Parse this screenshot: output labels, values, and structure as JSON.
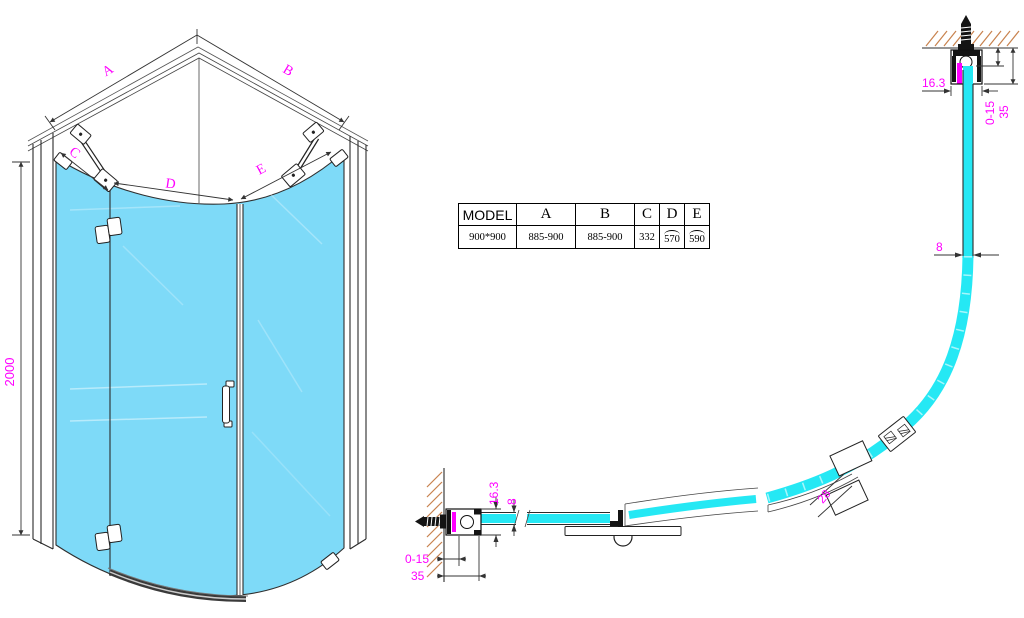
{
  "table": {
    "headers": [
      "MODEL",
      "A",
      "B",
      "C",
      "D",
      "E"
    ],
    "row": {
      "model": "900*900",
      "a": "885-900",
      "b": "885-900",
      "c": "332",
      "d": "570",
      "e": "590"
    }
  },
  "front_view": {
    "height": "2000",
    "dim_a": "A",
    "dim_b": "B",
    "dim_c": "C",
    "dim_d": "D",
    "dim_e": "E"
  },
  "plan_view": {
    "glass_thickness": "8",
    "profile_width": "16.3",
    "adjustment": "0-15",
    "profile_depth": "35",
    "handle_gap": "28"
  },
  "colors": {
    "glass_fill": "#7EDAF8",
    "section_glass": "#25E8F4",
    "dimension_text": "#FF00FF",
    "wall_hatch": "#C8824E",
    "line": "#2B2B2B"
  }
}
